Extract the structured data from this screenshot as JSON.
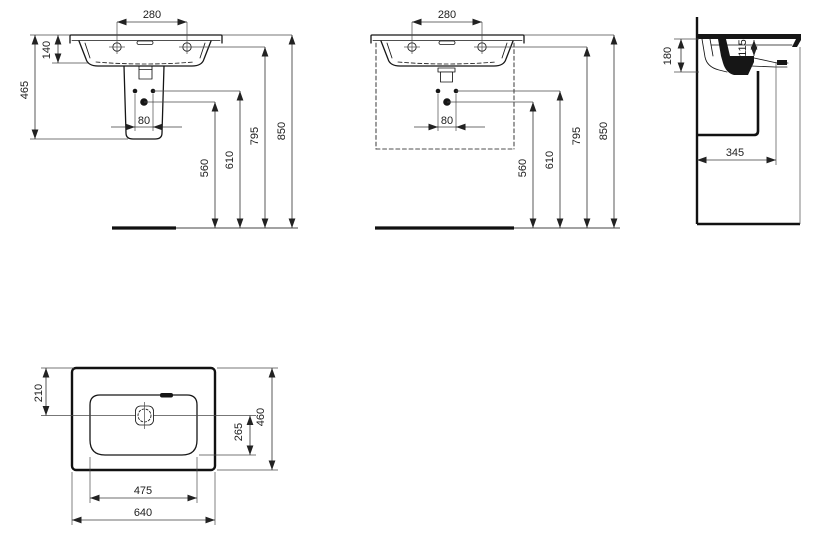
{
  "drawing": {
    "type": "washbasin-dimension-drawing",
    "colors": {
      "line": "#161616",
      "dim": "#3c3c3c",
      "bg": "#ffffff"
    },
    "views": {
      "v1": {
        "label": "front-view-with-semi-pedestal",
        "dims": {
          "d280": "280",
          "d140": "140",
          "d465": "465",
          "d80": "80",
          "d560": "560",
          "d610": "610",
          "d795": "795",
          "d850": "850"
        }
      },
      "v2": {
        "label": "front-view-with-furniture",
        "dims": {
          "d280": "280",
          "d80": "80",
          "d560": "560",
          "d610": "610",
          "d795": "795",
          "d850": "850"
        }
      },
      "v3": {
        "label": "side-section-view",
        "dims": {
          "d180": "180",
          "d115": "115",
          "d345": "345"
        }
      },
      "v4": {
        "label": "plan-view",
        "dims": {
          "d210": "210",
          "d265": "265",
          "d460": "460",
          "d475": "475",
          "d640": "640"
        }
      }
    }
  }
}
